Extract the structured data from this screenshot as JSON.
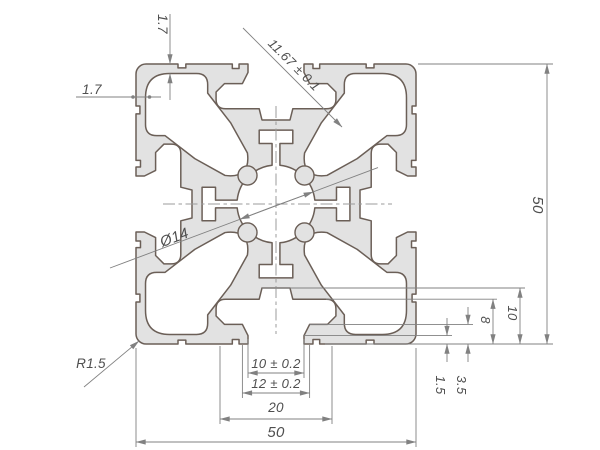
{
  "drawing": {
    "title": "aluminum-extrusion-profile-cross-section",
    "dimensions": {
      "top_wall_thickness": "1.7",
      "left_wall_thickness": "1.7",
      "diagonal_boss": "11.67 ± 0.1",
      "center_bore": "Ø14",
      "overall_height": "50",
      "slot_recess_depth": "10",
      "slot_cavity_depth": "8",
      "lip_thickness": "1.5",
      "lip_total_depth": "3.5",
      "slot_opening": "10 ± 0.2",
      "slot_opening_outer": "12 ± 0.2",
      "slot_cavity_width": "20",
      "overall_width": "50",
      "corner_radius": "R1.5"
    },
    "colors": {
      "profile_fill": "#e2e2e2",
      "profile_stroke": "#6b5f57",
      "dimension_lines": "#818181",
      "dimension_text": "#4f4f4f",
      "centerlines": "#9b9b9b",
      "background": "#ffffff"
    }
  }
}
